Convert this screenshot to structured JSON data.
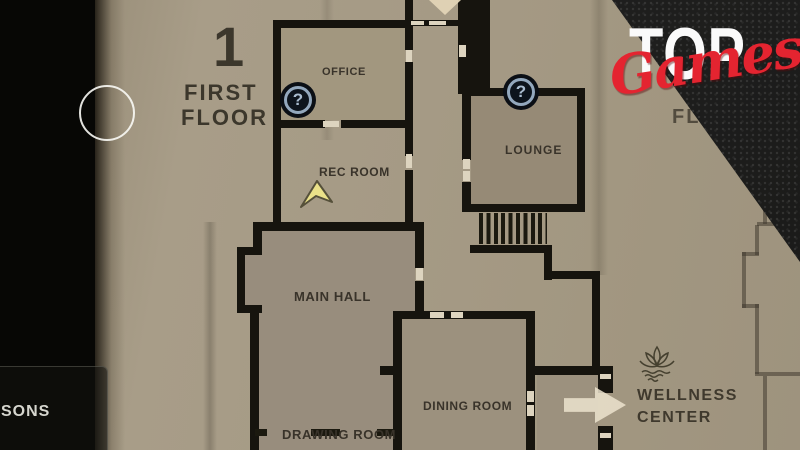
{
  "branding": {
    "top_text": "TOP",
    "games_text": "Games",
    "red": "#e42430",
    "white": "#fafafa"
  },
  "floor_header": {
    "number": "1",
    "line1": "FIRST",
    "line2": "FLOOR"
  },
  "adjacent_floor": {
    "label": "FLOOR"
  },
  "rooms": {
    "office": "OFFICE",
    "rec_room": "REC ROOM",
    "lounge": "LOUNGE",
    "main_hall": "MAIN HALL",
    "dining_room": "DINING ROOM",
    "drawing_room": "DRAWING ROOM",
    "wellness_line1": "WELLNESS",
    "wellness_line2": "CENTER"
  },
  "markers": {
    "question_glyph": "?"
  },
  "hud": {
    "partial_text": "SONS"
  },
  "colors": {
    "paper": "#a59a85",
    "wall": "#16140e",
    "badge_ring": "#93a8bd",
    "badge_fill": "#0d141c",
    "player_arrow": "#eae189",
    "accent_red": "#e42430"
  }
}
